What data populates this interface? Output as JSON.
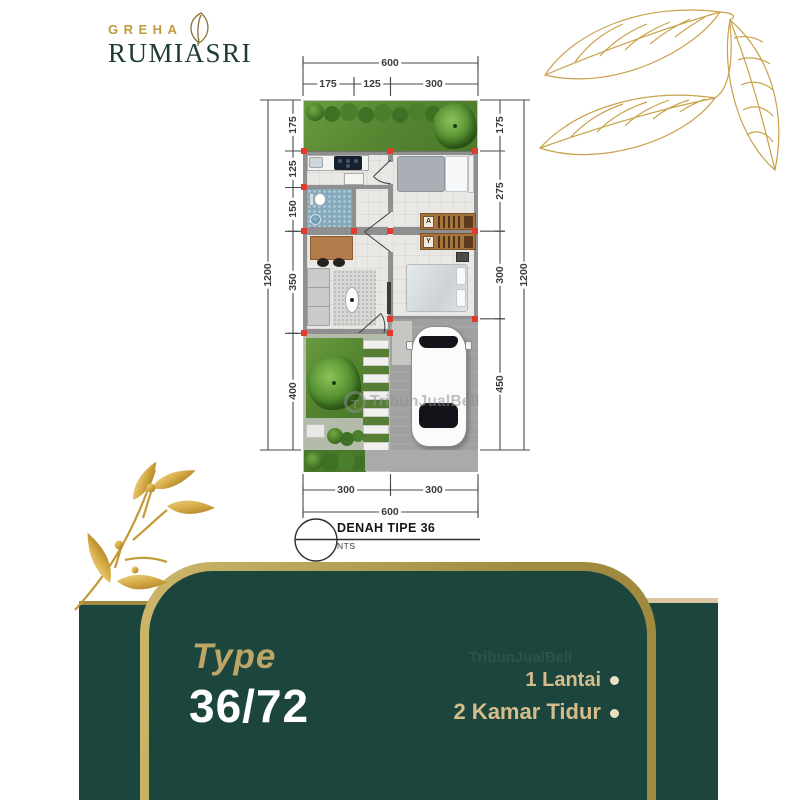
{
  "brand": {
    "top": "GREHA",
    "name": "RUMIASRI"
  },
  "dims": {
    "top": {
      "total": "600",
      "segs": [
        "175",
        "125",
        "300"
      ]
    },
    "left": {
      "total": "1200",
      "segs": [
        "175",
        "125",
        "150",
        "350",
        "400"
      ]
    },
    "right": {
      "total": "1200",
      "segs": [
        "175",
        "275",
        "300",
        "450"
      ]
    },
    "bottom": {
      "total": "600",
      "segs": [
        "300",
        "300"
      ]
    }
  },
  "caption": {
    "title": "DENAH TIPE 36",
    "scale_note": "NTS"
  },
  "watermark": {
    "text": "TribunJualBeli",
    "logo_letter": "T"
  },
  "footer": {
    "type_label": "Type",
    "type_value": "36/72",
    "features": [
      {
        "label": "1 Lantai"
      },
      {
        "label": "2 Kamar Tidur"
      }
    ]
  },
  "colors": {
    "panel_green": "#1c463d",
    "gold": "#a08a40",
    "gold_light": "#cdb76b",
    "cream": "#dcc6a1",
    "type_gold": "#bda467",
    "feature_gold": "#d6bc8c",
    "bullet_cream": "#ece0c4",
    "logo_gold": "#c09a3e",
    "logo_green": "#1e3c34",
    "column_red": "#e23b2e",
    "dim_ink": "#3c3c3c"
  }
}
